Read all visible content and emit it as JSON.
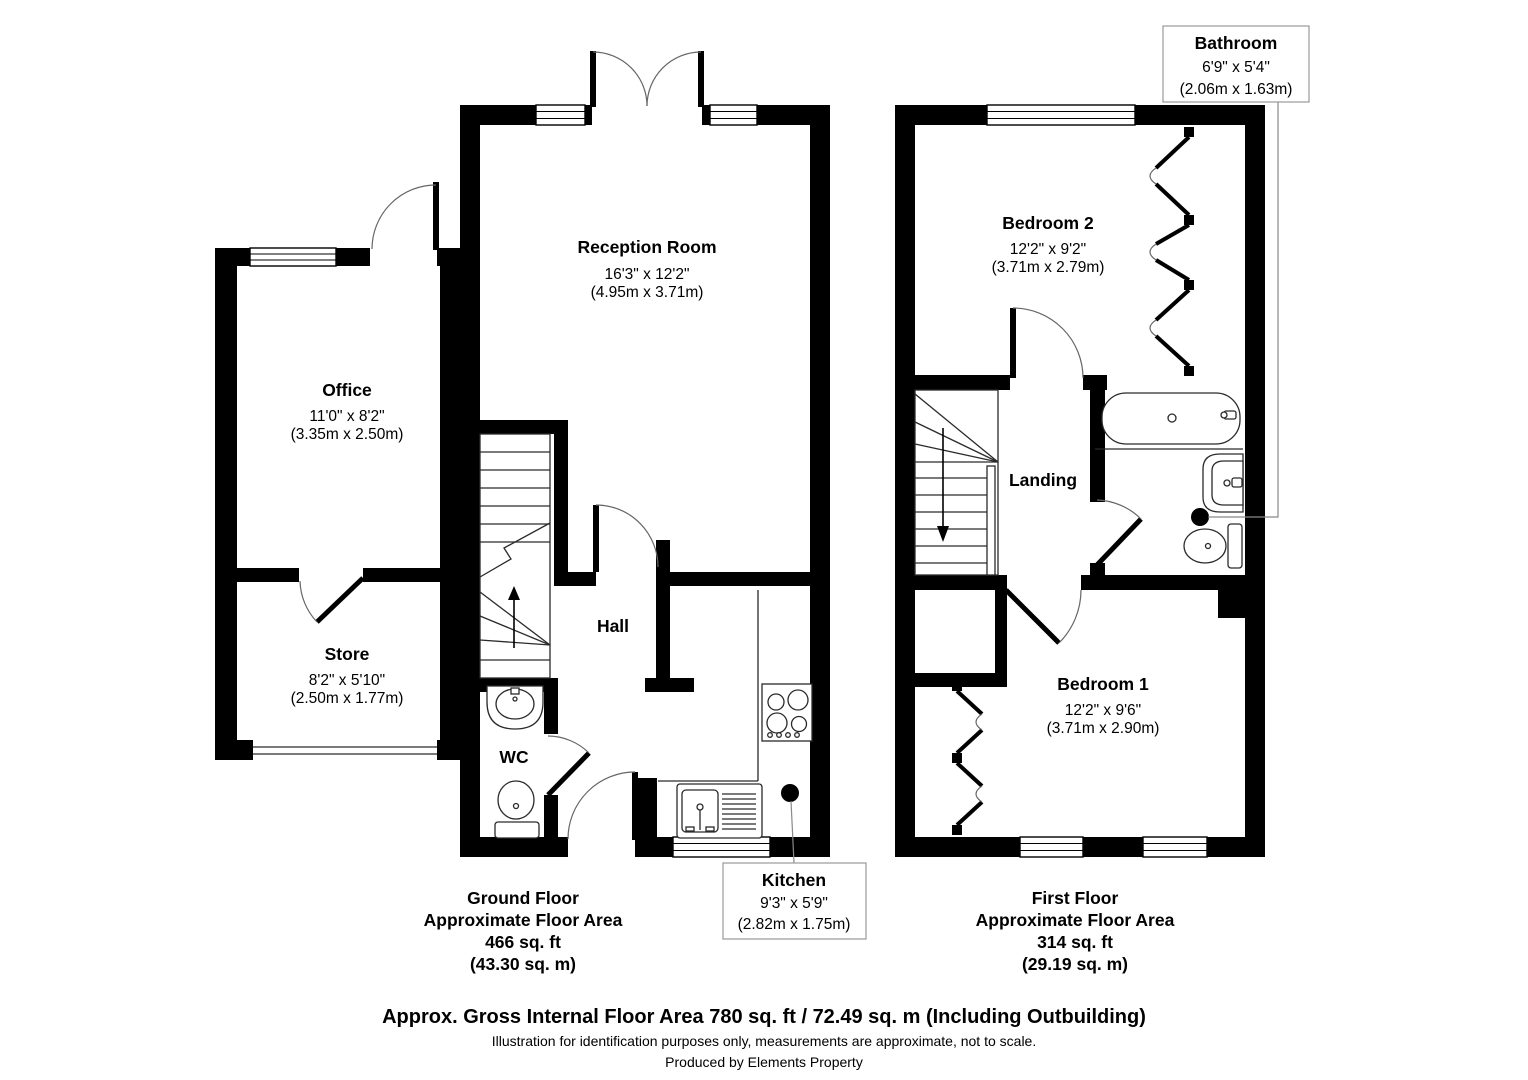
{
  "ground": {
    "rooms": {
      "reception": {
        "name": "Reception Room",
        "size_ft": "16'3\" x 12'2\"",
        "size_m": "(4.95m x 3.71m)"
      },
      "office": {
        "name": "Office",
        "size_ft": "11'0\" x 8'2\"",
        "size_m": "(3.35m x 2.50m)"
      },
      "store": {
        "name": "Store",
        "size_ft": "8'2\" x 5'10\"",
        "size_m": "(2.50m x 1.77m)"
      },
      "hall": {
        "name": "Hall"
      },
      "wc": {
        "name": "WC"
      },
      "kitchen": {
        "name": "Kitchen",
        "size_ft": "9'3\" x 5'9\"",
        "size_m": "(2.82m x 1.75m)"
      }
    },
    "title": {
      "floor": "Ground Floor",
      "label": "Approximate Floor Area",
      "area_ft": "466 sq. ft",
      "area_m": "(43.30 sq. m)"
    }
  },
  "first": {
    "rooms": {
      "bedroom2": {
        "name": "Bedroom 2",
        "size_ft": "12'2\" x 9'2\"",
        "size_m": "(3.71m x 2.79m)"
      },
      "bathroom": {
        "name": "Bathroom",
        "size_ft": "6'9\" x 5'4\"",
        "size_m": "(2.06m x 1.63m)"
      },
      "landing": {
        "name": "Landing"
      },
      "bedroom1": {
        "name": "Bedroom 1",
        "size_ft": "12'2\" x 9'6\"",
        "size_m": "(3.71m x 2.90m)"
      }
    },
    "title": {
      "floor": "First Floor",
      "label": "Approximate Floor Area",
      "area_ft": "314 sq. ft",
      "area_m": "(29.19 sq. m)"
    }
  },
  "footer": {
    "gross_area": "Approx. Gross Internal Floor Area 780 sq. ft / 72.49 sq. m (Including Outbuilding)",
    "disclaimer": "Illustration for identification purposes only, measurements are approximate, not to scale.",
    "credit": "Produced by Elements Property"
  }
}
